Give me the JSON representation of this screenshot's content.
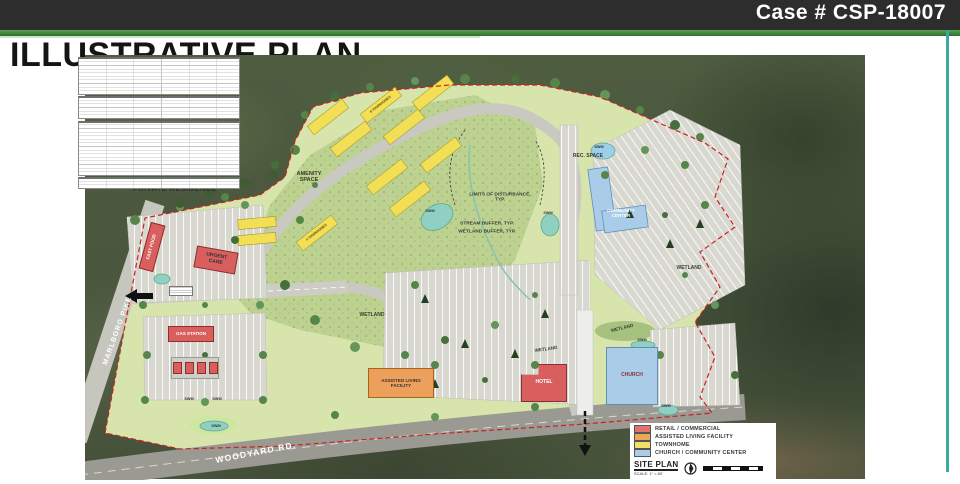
{
  "banner": {
    "case_label": "Case # CSP-18007"
  },
  "title": "ILLUSTRATIVE PLAN",
  "plan": {
    "roads": {
      "marlboro": "MARLBORO PIKE",
      "woodyard": "WOODYARD RD."
    },
    "labels": {
      "private_residence": "PRIVATE RESIDENCE",
      "amenity_space": "AMENITY SPACE",
      "rec_space": "REC. SPACE",
      "limits": "LIMITS OF DISTURBANCE, TYP.",
      "stream_buffer": "STREAM BUFFER, TYP.",
      "wetland_buffer": "WETLAND BUFFER, TYP.",
      "wetland": "WETLAND",
      "swm": "SWM",
      "townhomes_4": "4 TOWNHOMES",
      "townhomes_8": "8 TOWNHOMES"
    },
    "buildings": {
      "fast_food": "FAST FOOD",
      "urgent_care": "URGENT CARE",
      "gas_station": "GAS STATION",
      "assisted_living": "ASSISTED LIVING FACILITY",
      "hotel": "HOTEL",
      "church": "CHURCH",
      "community_center": "COMMUNITY CENTER"
    }
  },
  "legend": {
    "items": [
      {
        "label": "RETAIL / COMMERCIAL",
        "color": "#e2726e"
      },
      {
        "label": "ASSISTED LIVING FACILITY",
        "color": "#eda75a"
      },
      {
        "label": "TOWNHOME",
        "color": "#f3e066"
      },
      {
        "label": "CHURCH / COMMUNITY CENTER",
        "color": "#a9cfe8"
      }
    ],
    "site_plan_label": "SITE PLAN",
    "scale_label": "SCALE: 1\" = 80'"
  },
  "colors": {
    "boundary": "#cc2020",
    "site_green": "#d7e5ad",
    "meadow_green": "#bdd291",
    "pond_teal": "#8fd0c2",
    "accent_green_bar": "#2e7030",
    "banner_bg": "#2d2d2d",
    "teal_accent": "#3aa9a4"
  }
}
